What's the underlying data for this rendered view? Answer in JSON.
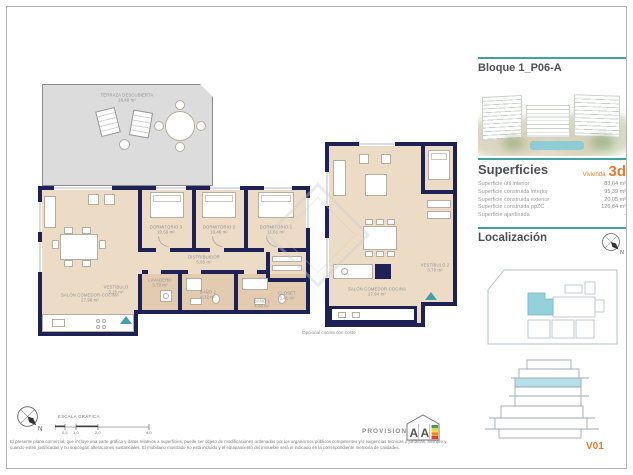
{
  "colors": {
    "teal": "#3fa3a3",
    "orange": "#e87c2d",
    "navy": "#1d2155",
    "beige": "#ecdcc6",
    "wet_beige": "#e3cbb0",
    "terrace_gray": "#dcdcdc",
    "highlight_blue": "#b5dfe9",
    "site_teal": "#93d2dc",
    "label_gray": "#8f8f93",
    "heading_gray": "#4e4e56"
  },
  "sidebar": {
    "block_title": "Bloque 1_P06-A",
    "superficies": {
      "heading": "Superficies",
      "vivienda_label": "Vivienda",
      "vivienda_value": "3d",
      "rows": [
        {
          "label": "Superficie útil interior",
          "value": "83,64 m²"
        },
        {
          "label": "Superficie construida interior",
          "value": "95,39 m²"
        },
        {
          "label": "Superficie construida exterior",
          "value": "20,05 m²"
        },
        {
          "label": "Superficie construida ppZC",
          "value": "126,84 m²"
        },
        {
          "label": "Superficie ajardinada",
          "value": "-"
        }
      ]
    },
    "localizacion": {
      "heading": "Localización"
    },
    "compass_n": "N",
    "version": "V01"
  },
  "plans": {
    "main": {
      "terraza": {
        "name": "TERRAZA DESCUBIERTA",
        "area": "18,40 m²"
      },
      "dormitorio3": {
        "name": "DORMITORIO 3",
        "area": "10,56 m²"
      },
      "dormitorio2": {
        "name": "DORMITORIO 2",
        "area": "10,46 m²"
      },
      "dormitorio1": {
        "name": "DORMITORIO 1",
        "area": "11,61 m²"
      },
      "distribuidor": {
        "name": "DISTRIBUIDOR",
        "area": "5,05 m²"
      },
      "closet": {
        "name": "CLOSET",
        "area": "3,41 m²"
      },
      "vestibulo": {
        "name": "VESTÍBULO",
        "area": "3,15 m²"
      },
      "lavadero": {
        "name": "LAVADERO",
        "area": "3,70 m²"
      },
      "bano2": {
        "name": "BAÑO 2",
        "area": "4,32 m²"
      },
      "bano1": {
        "name": "BAÑO 1",
        "area": "4,86 m²"
      },
      "salon": {
        "name": "SALÓN COMEDOR-COCINA",
        "area": "27,96 m²"
      }
    },
    "alt": {
      "vestibulo2": {
        "name": "VESTÍBULO 2",
        "area": "3,79 m²"
      },
      "salon": {
        "name": "SALÓN COMEDOR-COCINA",
        "area": "27,94 m²"
      },
      "caption": "Opcional cocina con coste"
    }
  },
  "scalebar": {
    "title": "ESCALA GRÁFICA",
    "labels": [
      "0,5",
      "1,0",
      "2,0",
      "4,0"
    ]
  },
  "footer": {
    "disclaimer_line1": "El presente plano comercial, que incluye una parte gráfica y datos relativos a superficies, puede ser objeto de modificaciones ordenadas por los organismos públicos competentes y/o exigencias técnicas o jurídicas, siempre y",
    "disclaimer_line2": "cuando estén justificadas y no supongan alteraciones sustanciales. El mobiliario mostrado no está incluido y el equipamiento del inmueble será el indicado en la correspondiente memoria de calidades.",
    "provisional": "PROVISIONAL",
    "energy": {
      "letter1": "A",
      "letter2": "A"
    }
  }
}
